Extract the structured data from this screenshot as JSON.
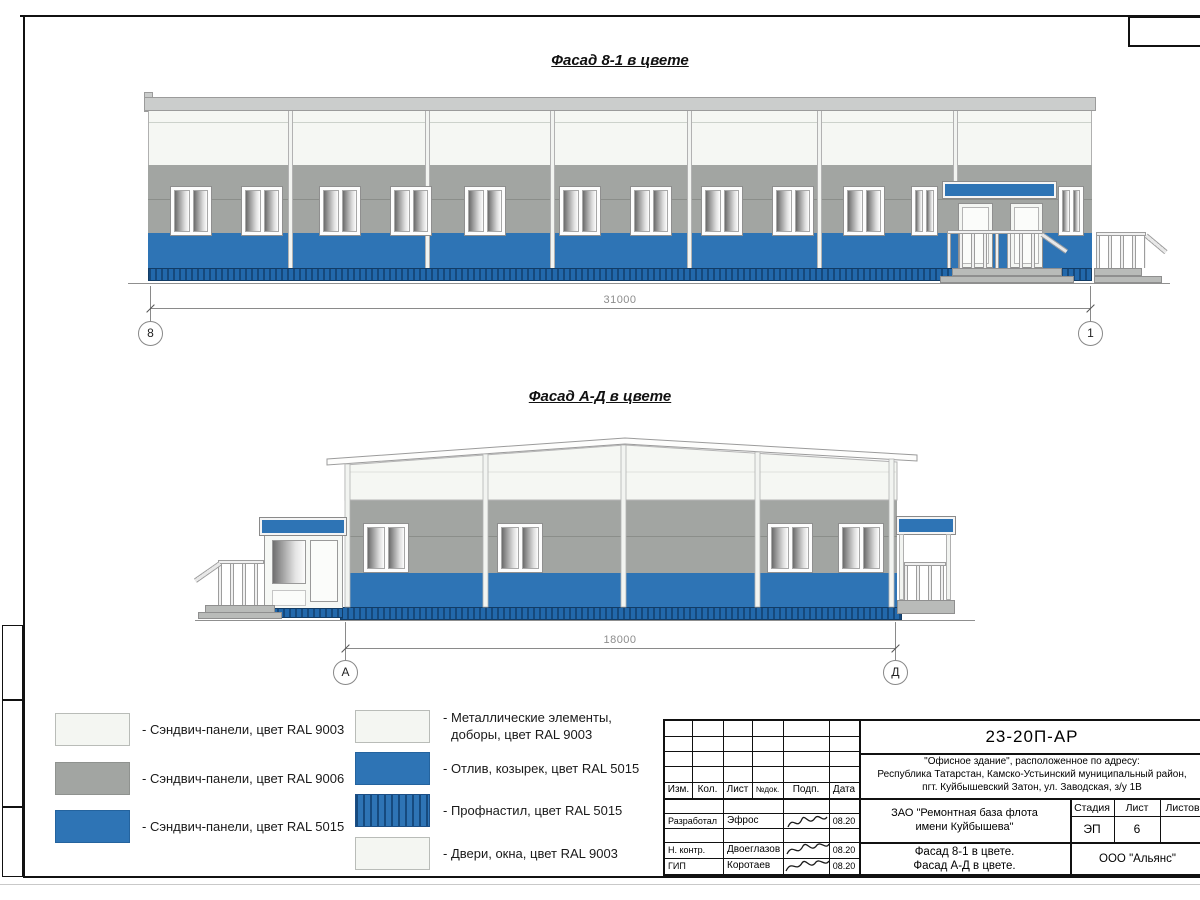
{
  "drawing": {
    "facade1": {
      "title": "Фасад 8-1 в цвете",
      "dimension": "31000",
      "axis_left": "8",
      "axis_right": "1"
    },
    "facade2": {
      "title": "Фасад А-Д в цвете",
      "dimension": "18000",
      "axis_left": "А",
      "axis_right": "Д"
    }
  },
  "legend": {
    "left": [
      {
        "label": "- Сэндвич-панели, цвет RAL 9003"
      },
      {
        "label": "- Сэндвич-панели, цвет RAL 9006"
      },
      {
        "label": "- Сэндвич-панели, цвет RAL 5015"
      }
    ],
    "right": [
      {
        "label_line1": "- Металлические элементы,",
        "label_line2": "доборы, цвет RAL 9003"
      },
      {
        "label_line1": "- Отлив, козырек, цвет RAL 5015"
      },
      {
        "label_line1": "- Профнастил, цвет RAL 5015"
      },
      {
        "label_line1": "- Двери, окна, цвет RAL 9003"
      }
    ]
  },
  "colors": {
    "blue_ral5015": "#2e74b5",
    "gray_ral9006": "#a2a5a2",
    "white_ral9003": "#f5f7f3",
    "profnastil": "#1f5c99"
  },
  "titleblock": {
    "doc_number": "23-20П-АР",
    "address_line1": "\"Офисное здание\", расположенное по адресу:",
    "address_line2": "Республика Татарстан, Камско-Устьинский муниципальный район,",
    "address_line3": "пгт. Куйбышевский Затон, ул. Заводская, з/у 1В",
    "col_izm": "Изм.",
    "col_kol": "Кол.",
    "col_list": "Лист",
    "col_ndok": "№док.",
    "col_podp": "Подп.",
    "col_data": "Дата",
    "rows": [
      {
        "role": "Разработал",
        "name": "Эфрос",
        "date": "08.20"
      },
      {
        "role": "Н. контр.",
        "name": "Двоеглазов",
        "date": "08.20"
      },
      {
        "role": "ГИП",
        "name": "Коротаев",
        "date": "08.20"
      }
    ],
    "client_line1": "ЗАО \"Ремонтная база флота",
    "client_line2": "имени Куйбышева\"",
    "stage_label": "Стадия",
    "sheet_label": "Лист",
    "sheets_label": "Листов",
    "stage_value": "ЭП",
    "sheet_value": "6",
    "subject_line1": "Фасад 8-1 в цвете.",
    "subject_line2": "Фасад А-Д в цвете.",
    "company": "ООО \"Альянс\""
  }
}
